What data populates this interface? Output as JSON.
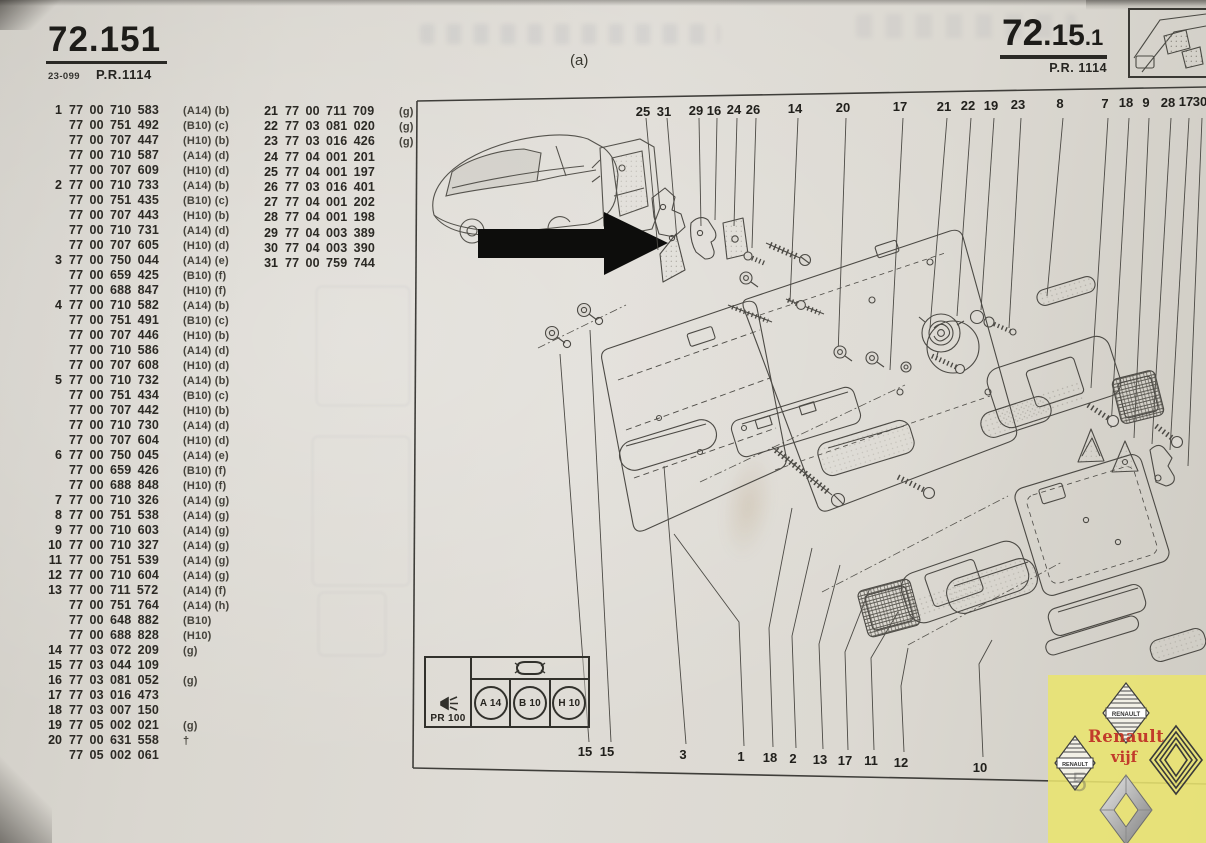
{
  "header_left": {
    "code": "72.151",
    "ref": "23-099",
    "pr": "P.R.1114"
  },
  "header_right": {
    "part1": "72",
    "part2": ".15",
    "part3": ".1",
    "pr": "P.R. 1114"
  },
  "figure_label": "(a)",
  "parts_list": {
    "column1": [
      {
        "i": "1",
        "p": "77 00 710 583",
        "s": "(A14) (b)"
      },
      {
        "i": "",
        "p": "77 00 751 492",
        "s": "(B10) (c)"
      },
      {
        "i": "",
        "p": "77 00 707 447",
        "s": "(H10) (b)"
      },
      {
        "i": "",
        "p": "77 00 710 587",
        "s": "(A14) (d)"
      },
      {
        "i": "",
        "p": "77 00 707 609",
        "s": "(H10) (d)"
      },
      {
        "i": "2",
        "p": "77 00 710 733",
        "s": "(A14) (b)"
      },
      {
        "i": "",
        "p": "77 00 751 435",
        "s": "(B10) (c)"
      },
      {
        "i": "",
        "p": "77 00 707 443",
        "s": "(H10) (b)"
      },
      {
        "i": "",
        "p": "77 00 710 731",
        "s": "(A14) (d)"
      },
      {
        "i": "",
        "p": "77 00 707 605",
        "s": "(H10) (d)"
      },
      {
        "i": "3",
        "p": "77 00 750 044",
        "s": "(A14) (e)"
      },
      {
        "i": "",
        "p": "77 00 659 425",
        "s": "(B10) (f)"
      },
      {
        "i": "",
        "p": "77 00 688 847",
        "s": "(H10) (f)"
      },
      {
        "i": "4",
        "p": "77 00 710 582",
        "s": "(A14) (b)"
      },
      {
        "i": "",
        "p": "77 00 751 491",
        "s": "(B10) (c)"
      },
      {
        "i": "",
        "p": "77 00 707 446",
        "s": "(H10) (b)"
      },
      {
        "i": "",
        "p": "77 00 710 586",
        "s": "(A14) (d)"
      },
      {
        "i": "",
        "p": "77 00 707 608",
        "s": "(H10) (d)"
      },
      {
        "i": "5",
        "p": "77 00 710 732",
        "s": "(A14) (b)"
      },
      {
        "i": "",
        "p": "77 00 751 434",
        "s": "(B10) (c)"
      },
      {
        "i": "",
        "p": "77 00 707 442",
        "s": "(H10) (b)"
      },
      {
        "i": "",
        "p": "77 00 710 730",
        "s": "(A14) (d)"
      },
      {
        "i": "",
        "p": "77 00 707 604",
        "s": "(H10) (d)"
      },
      {
        "i": "6",
        "p": "77 00 750 045",
        "s": "(A14) (e)"
      },
      {
        "i": "",
        "p": "77 00 659 426",
        "s": "(B10) (f)"
      },
      {
        "i": "",
        "p": "77 00 688 848",
        "s": "(H10) (f)"
      },
      {
        "i": "7",
        "p": "77 00 710 326",
        "s": "(A14) (g)"
      },
      {
        "i": "8",
        "p": "77 00 751 538",
        "s": "(A14) (g)"
      },
      {
        "i": "9",
        "p": "77 00 710 603",
        "s": "(A14) (g)"
      },
      {
        "i": "10",
        "p": "77 00 710 327",
        "s": "(A14) (g)"
      },
      {
        "i": "11",
        "p": "77 00 751 539",
        "s": "(A14) (g)"
      },
      {
        "i": "12",
        "p": "77 00 710 604",
        "s": "(A14) (g)"
      },
      {
        "i": "13",
        "p": "77 00 711 572",
        "s": "(A14) (f)"
      },
      {
        "i": "",
        "p": "77 00 751 764",
        "s": "(A14) (h)"
      },
      {
        "i": "",
        "p": "77 00 648 882",
        "s": "(B10)"
      },
      {
        "i": "",
        "p": "77 00 688 828",
        "s": "(H10)"
      },
      {
        "i": "14",
        "p": "77 03 072 209",
        "s": "(g)"
      },
      {
        "i": "15",
        "p": "77 03 044 109",
        "s": ""
      },
      {
        "i": "16",
        "p": "77 03 081 052",
        "s": "(g)"
      },
      {
        "i": "17",
        "p": "77 03 016 473",
        "s": ""
      },
      {
        "i": "18",
        "p": "77 03 007 150",
        "s": ""
      },
      {
        "i": "19",
        "p": "77 05 002 021",
        "s": "(g)"
      },
      {
        "i": "20",
        "p": "77 00 631 558",
        "s": "†"
      },
      {
        "i": "",
        "p": "77 05 002 061",
        "s": ""
      }
    ],
    "column2": [
      {
        "i": "21",
        "p": "77 00 711 709",
        "s": "(g)"
      },
      {
        "i": "22",
        "p": "77 03 081 020",
        "s": "(g)"
      },
      {
        "i": "23",
        "p": "77 03 016 426",
        "s": "(g)"
      },
      {
        "i": "24",
        "p": "77 04 001 201",
        "s": ""
      },
      {
        "i": "25",
        "p": "77 04 001 197",
        "s": ""
      },
      {
        "i": "26",
        "p": "77 03 016 401",
        "s": ""
      },
      {
        "i": "27",
        "p": "77 04 001 202",
        "s": ""
      },
      {
        "i": "28",
        "p": "77 04 001 198",
        "s": ""
      },
      {
        "i": "29",
        "p": "77 04 003 389",
        "s": ""
      },
      {
        "i": "30",
        "p": "77 04 003 390",
        "s": ""
      },
      {
        "i": "31",
        "p": "77 00 759 744",
        "s": ""
      }
    ]
  },
  "callouts": {
    "top": [
      {
        "label": "25",
        "x": 643,
        "y": 104
      },
      {
        "label": "31",
        "x": 664,
        "y": 104
      },
      {
        "label": "29",
        "x": 696,
        "y": 103
      },
      {
        "label": "16",
        "x": 714,
        "y": 103
      },
      {
        "label": "24",
        "x": 734,
        "y": 102
      },
      {
        "label": "26",
        "x": 753,
        "y": 102
      },
      {
        "label": "14",
        "x": 795,
        "y": 101
      },
      {
        "label": "20",
        "x": 843,
        "y": 100
      },
      {
        "label": "17",
        "x": 900,
        "y": 99
      },
      {
        "label": "21",
        "x": 944,
        "y": 99
      },
      {
        "label": "22",
        "x": 968,
        "y": 98
      },
      {
        "label": "19",
        "x": 991,
        "y": 98
      },
      {
        "label": "23",
        "x": 1018,
        "y": 97
      },
      {
        "label": "8",
        "x": 1060,
        "y": 96
      },
      {
        "label": "7",
        "x": 1105,
        "y": 96
      },
      {
        "label": "18",
        "x": 1126,
        "y": 95
      },
      {
        "label": "9",
        "x": 1146,
        "y": 95
      },
      {
        "label": "28",
        "x": 1168,
        "y": 95
      },
      {
        "label": "17",
        "x": 1186,
        "y": 94
      },
      {
        "label": "30",
        "x": 1200,
        "y": 94
      }
    ],
    "bottom": [
      {
        "label": "15",
        "x": 585,
        "y": 744
      },
      {
        "label": "15",
        "x": 607,
        "y": 744
      },
      {
        "label": "3",
        "x": 683,
        "y": 747
      },
      {
        "label": "1",
        "x": 741,
        "y": 749
      },
      {
        "label": "18",
        "x": 770,
        "y": 750
      },
      {
        "label": "2",
        "x": 793,
        "y": 751
      },
      {
        "label": "13",
        "x": 820,
        "y": 752
      },
      {
        "label": "17",
        "x": 845,
        "y": 753
      },
      {
        "label": "11",
        "x": 871,
        "y": 753
      },
      {
        "label": "12",
        "x": 901,
        "y": 755
      },
      {
        "label": "10",
        "x": 980,
        "y": 760
      }
    ]
  },
  "legend": {
    "pr_code": "PR 100",
    "trims": [
      "A 14",
      "B 10",
      "H 10"
    ]
  },
  "watermark": {
    "badge": "RENAULT",
    "line1": "Renault",
    "line2": "vijf",
    "ghost_digit": "5"
  }
}
